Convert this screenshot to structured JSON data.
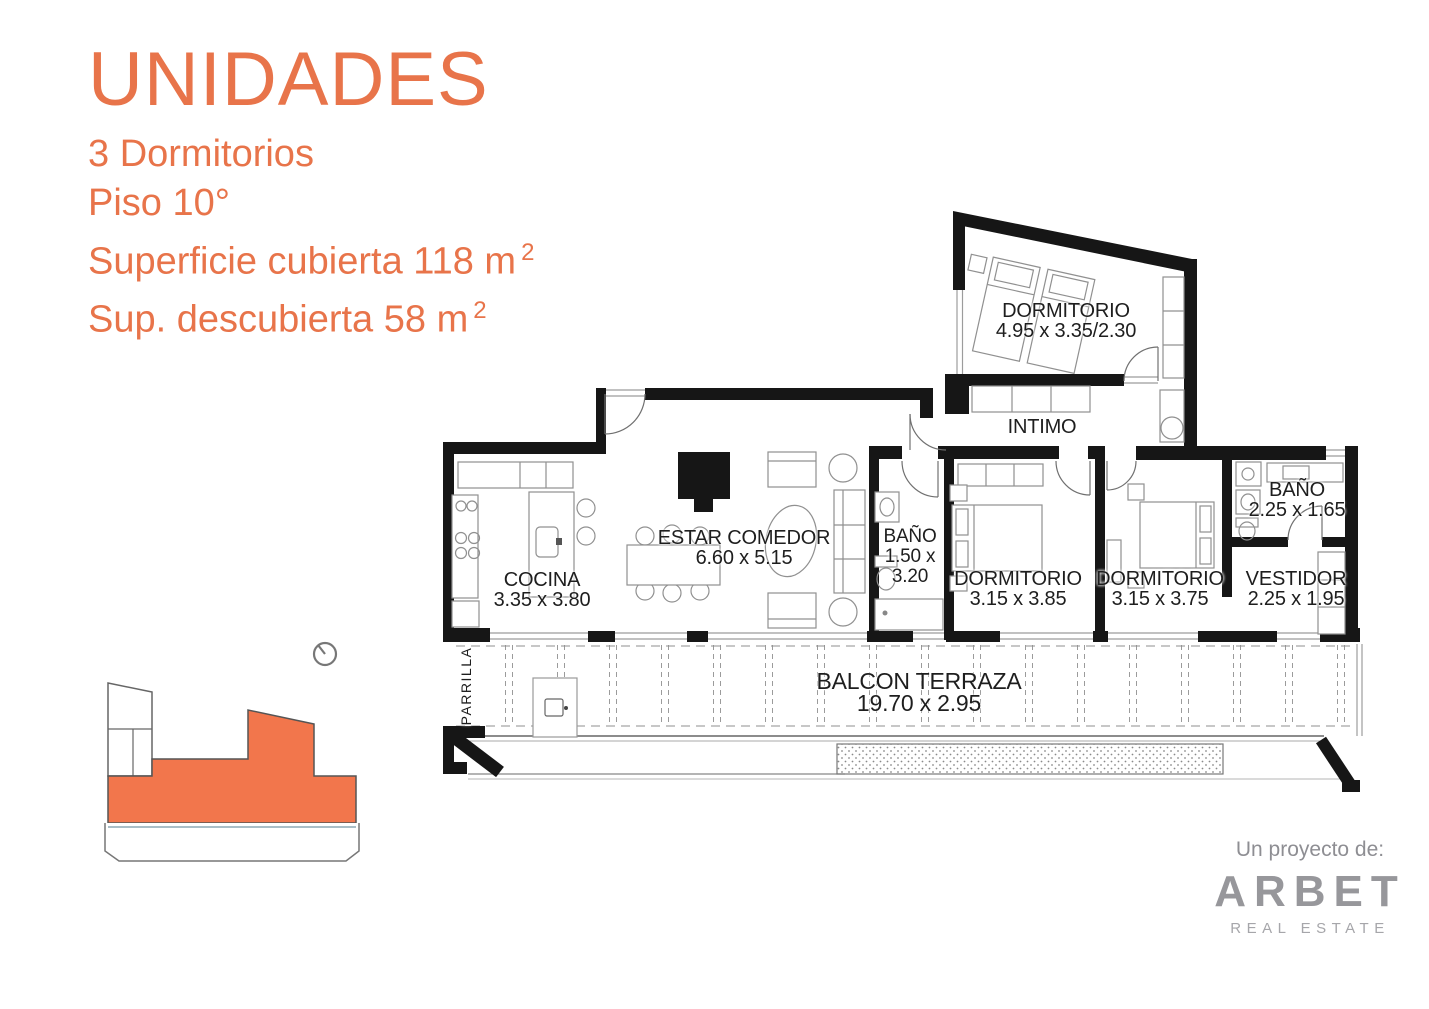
{
  "page": {
    "background": "#ffffff"
  },
  "header": {
    "title": "UNIDADES",
    "line_bedrooms": "3 Dormitorios",
    "line_floor": "Piso 10°",
    "line_covered": "Superficie cubierta 118 m",
    "line_covered_sup": "2",
    "line_uncovered": "Sup. descubierta 58 m",
    "line_uncovered_sup": "2",
    "accent_color": "#e8744a"
  },
  "floorplan": {
    "wall_color": "#161616",
    "rooms": {
      "dormitorio_principal": {
        "lines": [
          "DORMITORIO",
          "4.95 x 3.35/2.30"
        ]
      },
      "intimo": {
        "lines": [
          "INTIMO"
        ]
      },
      "bano_1": {
        "lines": [
          "BAÑO",
          "1.50 x",
          "3.20"
        ]
      },
      "dormitorio_2": {
        "lines": [
          "DORMITORIO",
          "3.15 x 3.85"
        ]
      },
      "dormitorio_3": {
        "lines": [
          "DORMITORIO",
          "3.15 x 3.75"
        ]
      },
      "vestidor": {
        "lines": [
          "VESTIDOR",
          "2.25 x 1.95"
        ]
      },
      "bano_2": {
        "lines": [
          "BAÑO",
          "2.25 x 1.65"
        ]
      },
      "estar_comedor": {
        "lines": [
          "ESTAR COMEDOR",
          "6.60 x 5.15"
        ]
      },
      "cocina": {
        "lines": [
          "COCINA",
          "3.35 x 3.80"
        ]
      },
      "balcon_terraza": {
        "lines": [
          "BALCON TERRAZA",
          "19.70 x 2.95"
        ]
      },
      "parrilla": {
        "lines": [
          "PARRILLA"
        ]
      }
    }
  },
  "key_plan": {
    "highlight_color": "#f2764c",
    "orientation_icon": "clock-dial-icon"
  },
  "logo": {
    "tagline": "Un proyecto de:",
    "brand": "ARBET",
    "subtitle": "REAL ESTATE",
    "color": "#97979b"
  }
}
